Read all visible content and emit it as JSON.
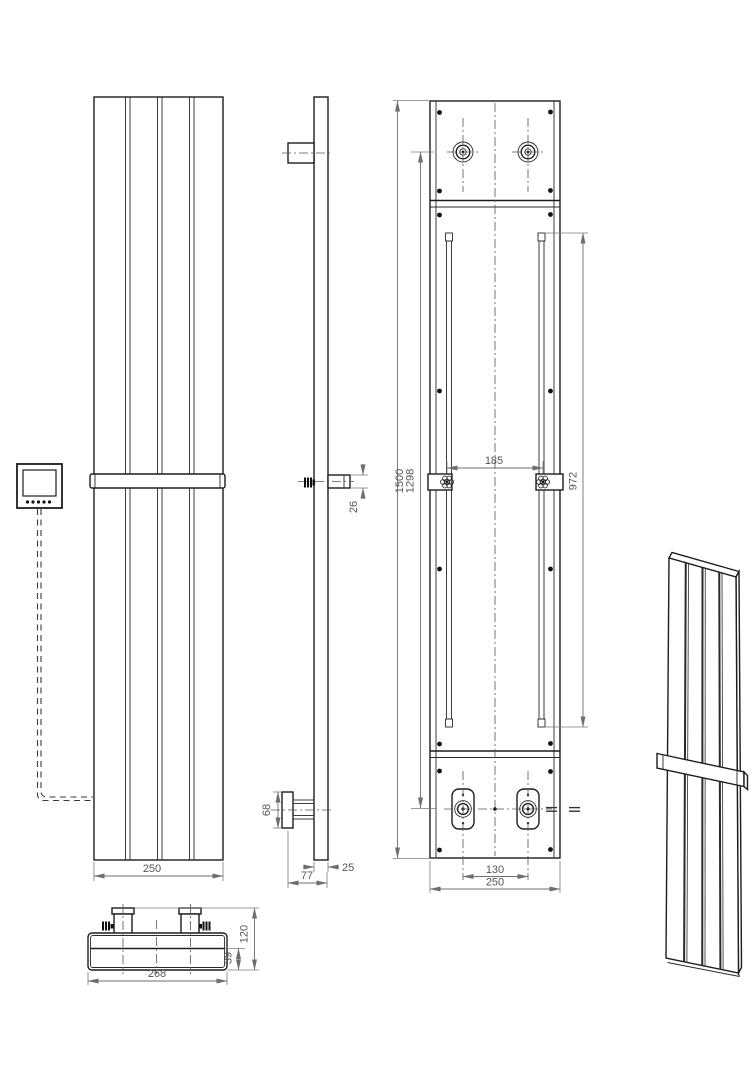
{
  "drawing": {
    "type": "radiator-technical-drawing",
    "colors": {
      "line": "#1d1d1d",
      "dimension": "#6e6e6e",
      "text": "#555555",
      "background": "#ffffff"
    },
    "dims": {
      "front_width": "250",
      "side_bar_offset": "26",
      "side_bracket_height": "68",
      "side_panel_thickness": "25",
      "side_total_depth": "77",
      "rear_total_height": "1500",
      "rear_mount_height": "1298",
      "rear_bracket_span": "185",
      "rear_rail_length": "972",
      "rear_valve_span": "130",
      "rear_width": "250",
      "bottom_total_width": "268",
      "bottom_total_depth": "120",
      "bottom_inner_depth": "39"
    }
  }
}
